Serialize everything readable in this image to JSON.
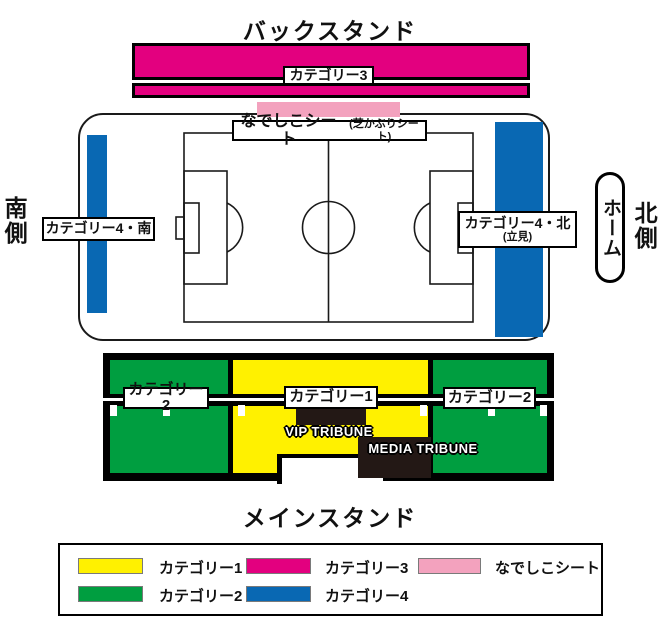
{
  "colors": {
    "category1": "#FFF100",
    "category2": "#009E40",
    "category3": "#E3007F",
    "category4": "#0968B3",
    "nadeshiko": "#F3A2BE",
    "dark_box": "#231815"
  },
  "back_stand": {
    "title": "バックスタンド",
    "category3_label": "カテゴリー3"
  },
  "field": {
    "nadeshiko_label": "なでしこシート",
    "nadeshiko_sub": "(芝かぶりシート)",
    "category4_south": "カテゴリー4・南",
    "category4_north": "カテゴリー4・北",
    "category4_north_note": "(立見)",
    "south_side": "南側",
    "north_side": "北側",
    "home": "ホーム"
  },
  "main_stand": {
    "title": "メインスタンド",
    "category1": "カテゴリー1",
    "category2_left": "カテゴリー2",
    "category2_right": "カテゴリー2",
    "vip": "VIP TRIBUNE",
    "media": "MEDIA TRIBUNE"
  },
  "legend": {
    "items": [
      {
        "label": "カテゴリー1",
        "color": "#FFF100"
      },
      {
        "label": "カテゴリー2",
        "color": "#009E40"
      },
      {
        "label": "カテゴリー3",
        "color": "#E3007F"
      },
      {
        "label": "カテゴリー4",
        "color": "#0968B3"
      },
      {
        "label": "なでしこシート",
        "color": "#F3A2BE"
      }
    ]
  }
}
